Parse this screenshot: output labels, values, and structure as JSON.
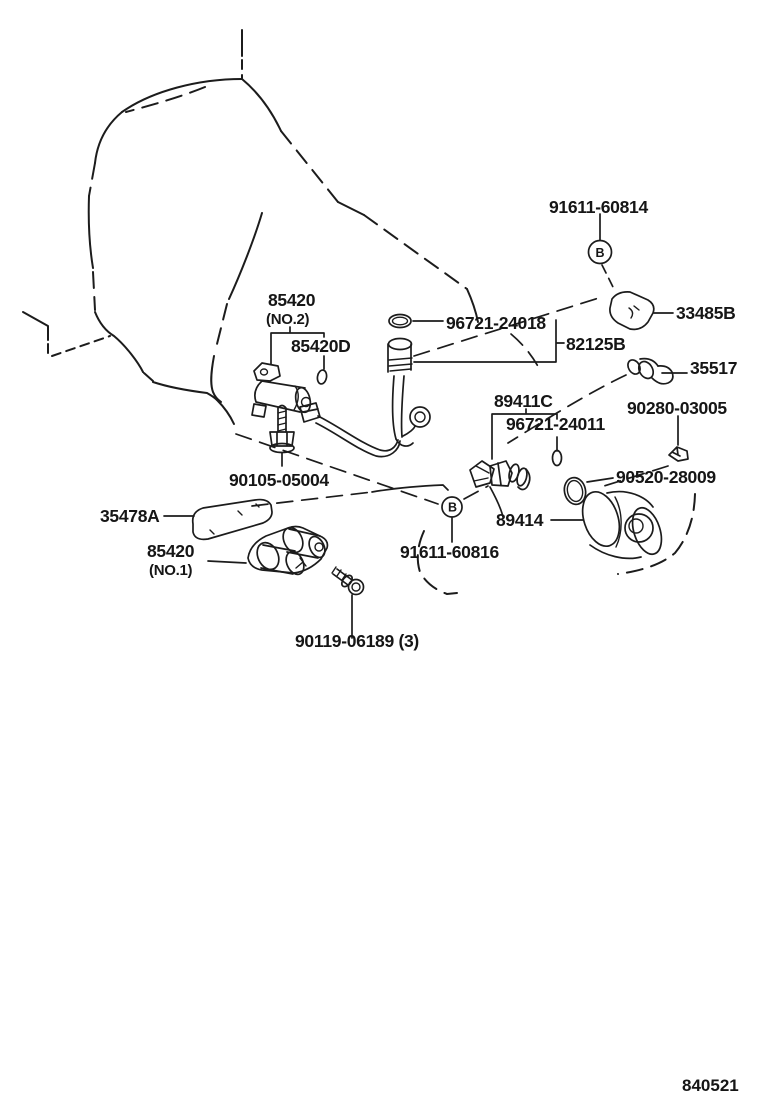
{
  "diagram": {
    "type": "exploded-parts-diagram",
    "figure_code": "840521",
    "colors": {
      "line": "#1c1c1c",
      "background": "#ffffff"
    },
    "part_labels": [
      {
        "text": "91611-60814"
      },
      {
        "text": "33485B"
      },
      {
        "text": "96721-24018"
      },
      {
        "text": "85420"
      },
      {
        "text": "(NO.2)"
      },
      {
        "text": "85420D"
      },
      {
        "text": "82125B"
      },
      {
        "text": "35517"
      },
      {
        "text": "89411C"
      },
      {
        "text": "96721-24011"
      },
      {
        "text": "90280-03005"
      },
      {
        "text": "90105-05004"
      },
      {
        "text": "90520-28009"
      },
      {
        "text": "35478A"
      },
      {
        "text": "89414"
      },
      {
        "text": "85420"
      },
      {
        "text": "(NO.1)"
      },
      {
        "text": "91611-60816"
      },
      {
        "text": "90119-06189 (3)"
      }
    ],
    "callout_markers": [
      {
        "letter": "B"
      },
      {
        "letter": "B"
      }
    ]
  }
}
